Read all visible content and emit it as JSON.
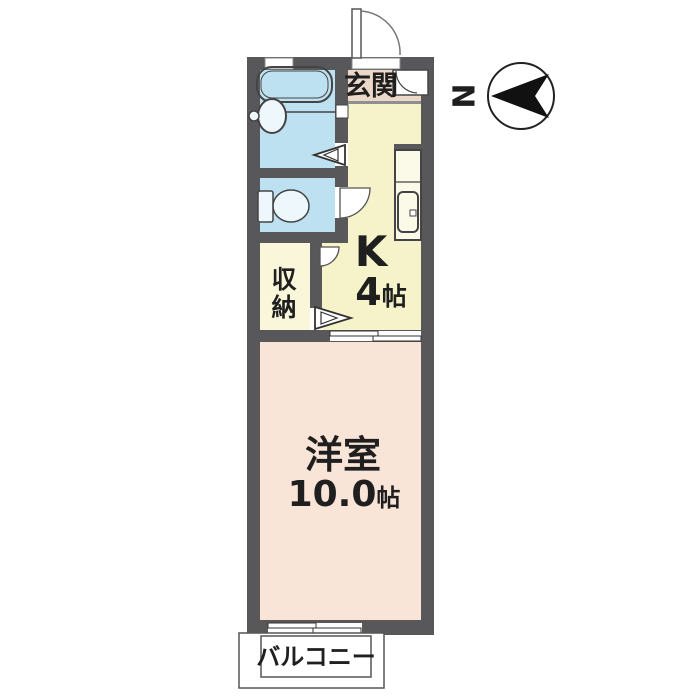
{
  "title": "1K apartment floor plan",
  "labels": {
    "genkan": "玄関",
    "kitchen": "K",
    "kitchen_size_value": "4",
    "kitchen_size_unit": "帖",
    "storage_char1": "収",
    "storage_char2": "納",
    "western": "洋室",
    "western_size_value": "10.0",
    "western_size_unit": "帖",
    "balcony": "バルコニー",
    "compass_n": "N"
  },
  "rooms": [
    {
      "id": "genkan",
      "label": "玄関"
    },
    {
      "id": "kitchen",
      "label": "K",
      "size": "4帖"
    },
    {
      "id": "storage",
      "label": "収納"
    },
    {
      "id": "western_room",
      "label": "洋室",
      "size": "10.0帖"
    },
    {
      "id": "balcony",
      "label": "バルコニー"
    }
  ],
  "colors": {
    "wall": "#58585B",
    "bathroom": "#BEE1F2",
    "toilet": "#BEE1F2",
    "kitchen": "#F6F2C9",
    "genkan": "#EAD9C8",
    "storage": "#FAF6DA",
    "western_room": "#F9E5D8",
    "fixture_fill": "#EDF7FC",
    "outline": "#444444",
    "text": "#1F1F1F",
    "compass": "#111111",
    "white": "#FFFFFF"
  }
}
